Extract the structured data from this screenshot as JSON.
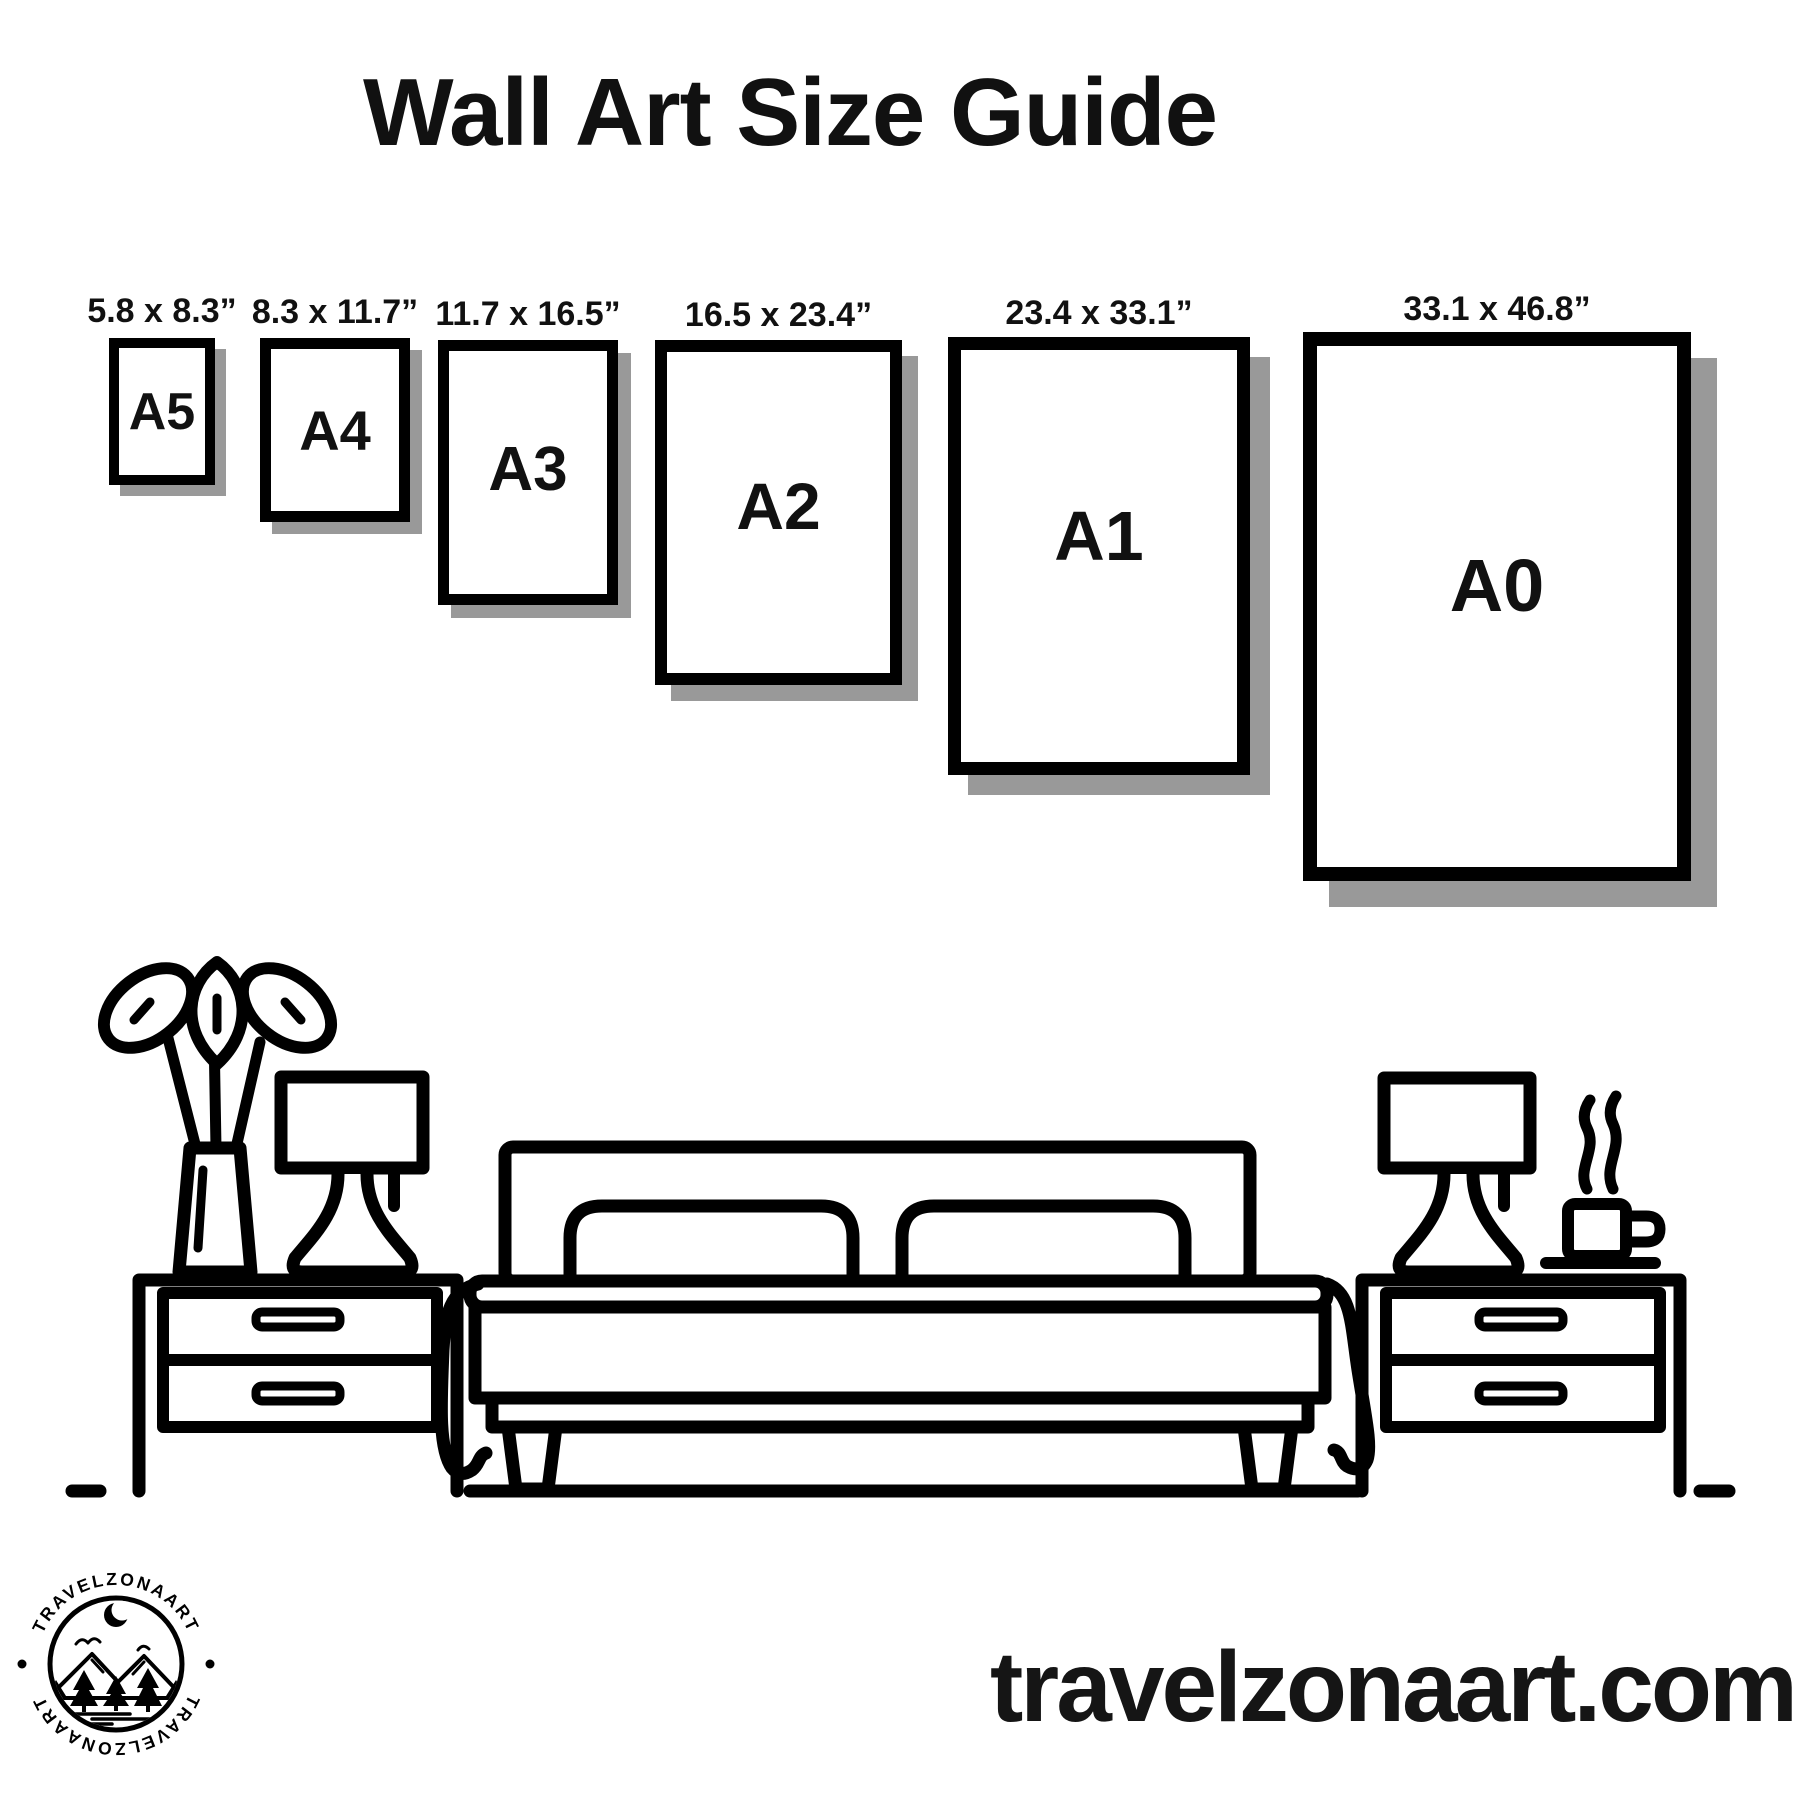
{
  "title": "Wall Art Size Guide",
  "sizes": [
    {
      "name": "A5",
      "dimensions": "5.8 x 8.3”"
    },
    {
      "name": "A4",
      "dimensions": "8.3 x 11.7”"
    },
    {
      "name": "A3",
      "dimensions": "11.7 x 16.5”"
    },
    {
      "name": "A2",
      "dimensions": "16.5 x 23.4”"
    },
    {
      "name": "A1",
      "dimensions": "23.4 x 33.1”"
    },
    {
      "name": "A0",
      "dimensions": "33.1 x 46.8”"
    }
  ],
  "logo": {
    "brand_top": "TRAVELZONAART",
    "brand_bottom": "TRAVELZONAART"
  },
  "website": "travelzonaart.com",
  "colors": {
    "ink": "#000000",
    "shadow": "#999999",
    "background": "#ffffff",
    "text": "#111111"
  }
}
